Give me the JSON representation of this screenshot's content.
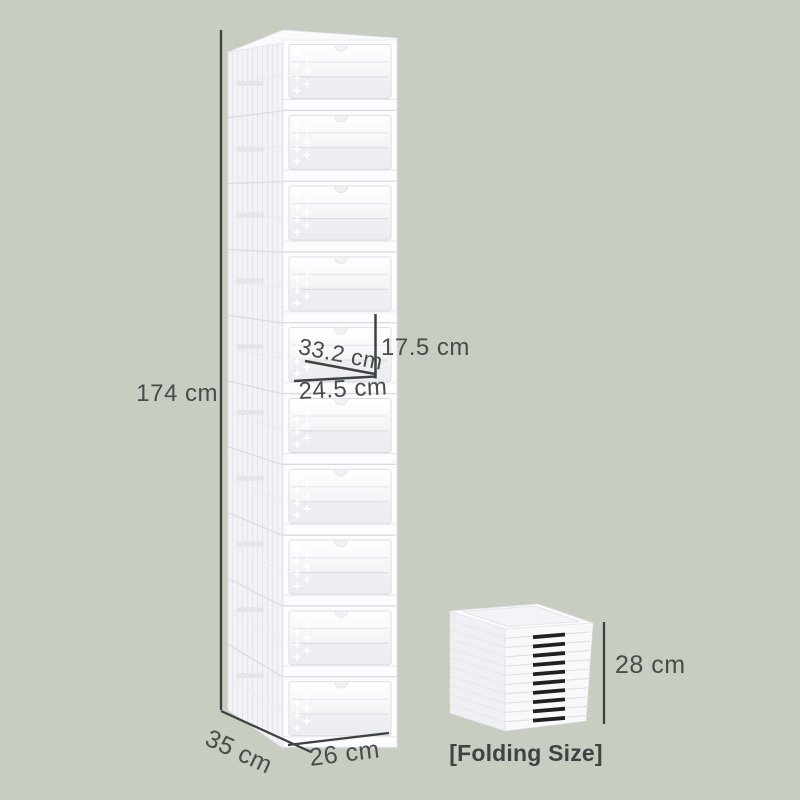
{
  "page": {
    "background_color": "#c7cdc0",
    "annotation_color": "#474c4c"
  },
  "product": {
    "type": "foldable stackable shoe box storage tower",
    "stacked_boxes": 10,
    "folded_slots": 10
  },
  "annotations": {
    "total_height": "174 cm",
    "inner_diagonal": "33.2 cm",
    "inner_height": "17.5 cm",
    "inner_width": "24.5 cm",
    "depth": "35 cm",
    "width": "26 cm",
    "folded_height": "28 cm",
    "folding_label": "[Folding Size]"
  }
}
